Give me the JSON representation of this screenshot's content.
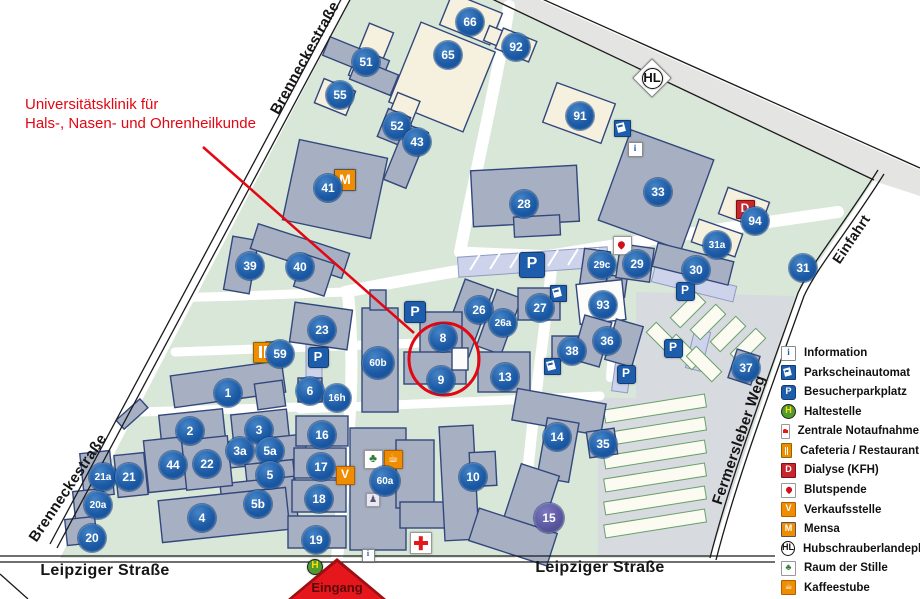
{
  "annotation": {
    "line1": "Universitätsklinik für",
    "line2": "Hals-, Nasen- und Ohrenheilkunde",
    "color": "#e30613"
  },
  "entrance": {
    "label": "Eingang"
  },
  "streets": [
    {
      "text": "Brenneckestraße",
      "x": 305,
      "y": 58,
      "rot": -61,
      "size": 15
    },
    {
      "text": "Brenneckestraße",
      "x": 68,
      "y": 488,
      "rot": -56,
      "size": 15
    },
    {
      "text": "Leipziger Straße",
      "x": 105,
      "y": 571,
      "rot": 0,
      "size": 16
    },
    {
      "text": "Leipziger Straße",
      "x": 600,
      "y": 568,
      "rot": 0,
      "size": 16
    },
    {
      "text": "Fermersleber Weg",
      "x": 739,
      "y": 440,
      "rot": -71,
      "size": 15
    },
    {
      "text": "Einfahrt",
      "x": 851,
      "y": 239,
      "rot": -56,
      "size": 14
    }
  ],
  "colors": {
    "marker_blue": "#1c5aa5",
    "marker_purple": "#5b57a0",
    "campus_green": "#d9e7d9",
    "building_gray": "#a7afc2",
    "building_cream": "#f6f1df",
    "annotation_red": "#e30613"
  },
  "icon_defs": {
    "information": {
      "glyph": "i",
      "bg": "#ffffff",
      "fg": "#1d5dab",
      "border": "#8a8a8a",
      "shape": "square",
      "serif": true
    },
    "parkscheinautomat": {
      "glyph": "",
      "bg": "#1d5dab",
      "fg": "#ffffff",
      "border": "#123c74",
      "shape": "square",
      "special": "ticket"
    },
    "besucherparkplatz": {
      "glyph": "P",
      "bg": "#1d5dab",
      "fg": "#ffffff",
      "border": "#123c74",
      "shape": "rounded"
    },
    "haltestelle": {
      "glyph": "H",
      "bg": "#4f9b2e",
      "fg": "#ffe000",
      "border": "#222222",
      "shape": "circle"
    },
    "notaufnahme": {
      "glyph": "",
      "bg": "#ffffff",
      "fg": "#e2181d",
      "border": "#999999",
      "shape": "square",
      "special": "cross"
    },
    "cafeteria": {
      "glyph": "",
      "bg": "#ef8c00",
      "fg": "#ffffff",
      "border": "#8a6a00",
      "shape": "square",
      "special": "utensils"
    },
    "dialyse": {
      "glyph": "D",
      "bg": "#c9252c",
      "fg": "#ffffff",
      "border": "#7c1114",
      "shape": "square"
    },
    "blutspende": {
      "glyph": "",
      "bg": "#ffffff",
      "fg": "#d01218",
      "border": "#999999",
      "shape": "square",
      "special": "drop"
    },
    "verkaufsstelle": {
      "glyph": "V",
      "bg": "#ef8c00",
      "fg": "#ffffff",
      "border": "#b06000",
      "shape": "square"
    },
    "mensa": {
      "glyph": "M",
      "bg": "#ef8c00",
      "fg": "#ffffff",
      "border": "#555555",
      "shape": "square"
    },
    "hubschrauberlandeplatz": {
      "glyph": "HL",
      "bg": "#ffffff",
      "fg": "#111111",
      "border": "#111111",
      "shape": "circle"
    },
    "helipad_pad": {
      "glyph": "",
      "bg": "#ffffff",
      "fg": "#111111",
      "border": "#888888",
      "shape": "square",
      "rot": 45
    },
    "raum_der_stille": {
      "glyph": "♣",
      "bg": "#ffffff",
      "fg": "#2e7d32",
      "border": "#999999",
      "shape": "square"
    },
    "kaffeestube": {
      "glyph": "☕",
      "bg": "#ef8c00",
      "fg": "#ffffff",
      "border": "#b06000",
      "shape": "square"
    },
    "statue": {
      "glyph": "♟",
      "bg": "#e9e9ef",
      "fg": "#555577",
      "border": "#9a9aac",
      "shape": "square"
    }
  },
  "legend": {
    "items": [
      {
        "type": "information",
        "label": "Information"
      },
      {
        "type": "parkscheinautomat",
        "label": "Parkscheinautomat"
      },
      {
        "type": "besucherparkplatz",
        "label": "Besucherparkplatz"
      },
      {
        "type": "haltestelle",
        "label": "Haltestelle"
      },
      {
        "type": "notaufnahme",
        "label": "Zentrale Notaufnahme"
      },
      {
        "type": "cafeteria",
        "label": "Cafeteria / Restaurant"
      },
      {
        "type": "dialyse",
        "label": "Dialyse (KFH)"
      },
      {
        "type": "blutspende",
        "label": "Blutspende"
      },
      {
        "type": "verkaufsstelle",
        "label": "Verkaufsstelle"
      },
      {
        "type": "mensa",
        "label": "Mensa"
      },
      {
        "type": "hubschrauberlandeplatz",
        "label": "Hubschrauberlandeplatz"
      },
      {
        "type": "raum_der_stille",
        "label": "Raum der Stille"
      },
      {
        "type": "kaffeestube",
        "label": "Kaffeestube"
      }
    ]
  },
  "map": {
    "markers": [
      {
        "n": "66",
        "x": 470,
        "y": 22
      },
      {
        "n": "92",
        "x": 516,
        "y": 47
      },
      {
        "n": "51",
        "x": 366,
        "y": 62
      },
      {
        "n": "65",
        "x": 448,
        "y": 55
      },
      {
        "n": "55",
        "x": 340,
        "y": 95
      },
      {
        "n": "91",
        "x": 580,
        "y": 116
      },
      {
        "n": "52",
        "x": 397,
        "y": 126
      },
      {
        "n": "43",
        "x": 417,
        "y": 142
      },
      {
        "n": "41",
        "x": 328,
        "y": 188
      },
      {
        "n": "28",
        "x": 524,
        "y": 204
      },
      {
        "n": "33",
        "x": 658,
        "y": 192
      },
      {
        "n": "94",
        "x": 755,
        "y": 221
      },
      {
        "n": "29c",
        "x": 602,
        "y": 265
      },
      {
        "n": "29",
        "x": 637,
        "y": 264
      },
      {
        "n": "31a",
        "x": 717,
        "y": 245
      },
      {
        "n": "30",
        "x": 696,
        "y": 270
      },
      {
        "n": "31",
        "x": 803,
        "y": 268
      },
      {
        "n": "39",
        "x": 250,
        "y": 266
      },
      {
        "n": "40",
        "x": 300,
        "y": 267
      },
      {
        "n": "26",
        "x": 479,
        "y": 310
      },
      {
        "n": "26a",
        "x": 503,
        "y": 323
      },
      {
        "n": "27",
        "x": 540,
        "y": 308
      },
      {
        "n": "93",
        "x": 603,
        "y": 305
      },
      {
        "n": "23",
        "x": 322,
        "y": 330
      },
      {
        "n": "59",
        "x": 280,
        "y": 354
      },
      {
        "n": "8",
        "x": 443,
        "y": 338
      },
      {
        "n": "13",
        "x": 505,
        "y": 377
      },
      {
        "n": "38",
        "x": 572,
        "y": 351
      },
      {
        "n": "36",
        "x": 607,
        "y": 341
      },
      {
        "n": "37",
        "x": 746,
        "y": 368
      },
      {
        "n": "1",
        "x": 228,
        "y": 393
      },
      {
        "n": "6",
        "x": 310,
        "y": 391
      },
      {
        "n": "16h",
        "x": 337,
        "y": 398
      },
      {
        "n": "9",
        "x": 441,
        "y": 380
      },
      {
        "n": "60b",
        "x": 378,
        "y": 363,
        "s": 32
      },
      {
        "n": "2",
        "x": 190,
        "y": 431
      },
      {
        "n": "3",
        "x": 259,
        "y": 430
      },
      {
        "n": "3a",
        "x": 240,
        "y": 451
      },
      {
        "n": "5a",
        "x": 270,
        "y": 451
      },
      {
        "n": "5",
        "x": 270,
        "y": 475
      },
      {
        "n": "16",
        "x": 322,
        "y": 435
      },
      {
        "n": "44",
        "x": 173,
        "y": 465
      },
      {
        "n": "22",
        "x": 207,
        "y": 464
      },
      {
        "n": "17",
        "x": 321,
        "y": 467
      },
      {
        "n": "60a",
        "x": 385,
        "y": 481,
        "s": 30
      },
      {
        "n": "10",
        "x": 473,
        "y": 477
      },
      {
        "n": "14",
        "x": 557,
        "y": 437
      },
      {
        "n": "35",
        "x": 603,
        "y": 444
      },
      {
        "n": "15",
        "x": 549,
        "y": 518,
        "s": 30,
        "c": "#5b57a0"
      },
      {
        "n": "21a",
        "x": 103,
        "y": 477
      },
      {
        "n": "21",
        "x": 129,
        "y": 477
      },
      {
        "n": "5b",
        "x": 258,
        "y": 504
      },
      {
        "n": "18",
        "x": 319,
        "y": 499
      },
      {
        "n": "4",
        "x": 202,
        "y": 518
      },
      {
        "n": "19",
        "x": 316,
        "y": 540
      },
      {
        "n": "20a",
        "x": 98,
        "y": 505
      },
      {
        "n": "20",
        "x": 92,
        "y": 538
      }
    ],
    "icons": [
      {
        "type": "mensa",
        "x": 345,
        "y": 180,
        "s": 22
      },
      {
        "type": "helipad_pad",
        "x": 652,
        "y": 78,
        "s": 28
      },
      {
        "type": "hubschrauberlandeplatz",
        "x": 652,
        "y": 78,
        "s": 21
      },
      {
        "type": "parkscheinautomat",
        "x": 622,
        "y": 128,
        "s": 17
      },
      {
        "type": "information",
        "x": 635,
        "y": 149,
        "s": 15
      },
      {
        "type": "dialyse",
        "x": 745,
        "y": 209,
        "s": 19
      },
      {
        "type": "blutspende",
        "x": 622,
        "y": 245,
        "s": 19
      },
      {
        "type": "besucherparkplatz",
        "x": 415,
        "y": 312,
        "s": 22
      },
      {
        "type": "besucherparkplatz",
        "x": 318,
        "y": 357,
        "s": 21
      },
      {
        "type": "besucherparkplatz",
        "x": 532,
        "y": 265,
        "s": 26
      },
      {
        "type": "besucherparkplatz",
        "x": 685,
        "y": 291,
        "s": 19
      },
      {
        "type": "besucherparkplatz",
        "x": 673,
        "y": 348,
        "s": 19
      },
      {
        "type": "besucherparkplatz",
        "x": 626,
        "y": 374,
        "s": 19
      },
      {
        "type": "parkscheinautomat",
        "x": 558,
        "y": 293,
        "s": 17
      },
      {
        "type": "parkscheinautomat",
        "x": 552,
        "y": 366,
        "s": 17
      },
      {
        "type": "cafeteria",
        "x": 263,
        "y": 352,
        "s": 21
      },
      {
        "type": "verkaufsstelle",
        "x": 345,
        "y": 475,
        "s": 19
      },
      {
        "type": "raum_der_stille",
        "x": 373,
        "y": 459,
        "s": 19
      },
      {
        "type": "kaffeestube",
        "x": 393,
        "y": 459,
        "s": 19
      },
      {
        "type": "statue",
        "x": 373,
        "y": 500,
        "s": 14
      },
      {
        "type": "notaufnahme",
        "x": 421,
        "y": 543,
        "s": 22
      },
      {
        "type": "haltestelle",
        "x": 315,
        "y": 567,
        "s": 16
      },
      {
        "type": "information",
        "x": 368,
        "y": 555,
        "s": 13
      }
    ]
  }
}
